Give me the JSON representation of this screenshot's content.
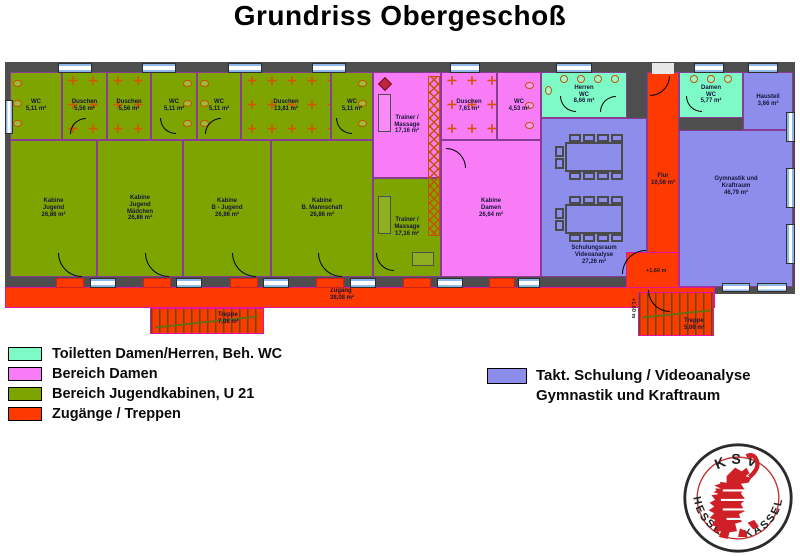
{
  "title": "Grundriss Obergeschoß",
  "rooms": {
    "wc1": {
      "label": "WC\n5,11 m²"
    },
    "du1": {
      "label": "Duschen\n5,56 m²"
    },
    "du2": {
      "label": "Duschen\n5,56 m²"
    },
    "wc2": {
      "label": "WC\n5,11 m²"
    },
    "wc3": {
      "label": "WC\n5,11 m²"
    },
    "duw": {
      "label": "Duschen\n13,81 m²"
    },
    "wc4": {
      "label": "WC\n5,11 m²"
    },
    "kab1": {
      "label": "Kabine\nJugend\n26,86 m²"
    },
    "kab2": {
      "label": "Kabine\nJugend\nMädchen\n26,86 m²"
    },
    "kab3": {
      "label": "Kabine\nB - Jugend\n26,86 m²"
    },
    "kab4": {
      "label": "Kabine\nB. Mannschaft\n26,86 m²"
    },
    "tm_pink": {
      "label": "Trainer /\nMassage\n17,16 m²"
    },
    "tm_green": {
      "label": "Trainer /\nMassage\n17,16 m²"
    },
    "du_damen": {
      "label": "Duschen\n7,61 m²"
    },
    "wc_damen": {
      "label": "WC\n4,53 m²"
    },
    "kab_damen": {
      "label": "Kabine\nDamen\n26,64 m²"
    },
    "herren_wc": {
      "label": "Herren\nWC\n8,66 m²"
    },
    "damen_wc": {
      "label": "Damen\nWC\n5,77 m²"
    },
    "hausteil": {
      "label": "Hausteil\n3,66 m²"
    },
    "flur": {
      "label": "Flur\n10,56 m²"
    },
    "schulung": {
      "label": "Schulungsraum\nVideoanalyse\n27,26 m²"
    },
    "gym": {
      "label": "Gymnastik und\nKraftraum\n46,79 m²"
    },
    "zugang": {
      "label": "Zugang\n38,08 m²"
    },
    "treppe1": {
      "label": "Treppe\n7,08 m²"
    },
    "treppe2": {
      "label": "Treppe\n5,06 m²"
    }
  },
  "annotations": {
    "level_a": "+1,60 m",
    "level_b": "+1,60 m"
  },
  "legend_left": [
    {
      "label": "Toiletten Damen/Herren, Beh. WC",
      "color": "#7efac6"
    },
    {
      "label": "Bereich Damen",
      "color": "#f87cf6"
    },
    {
      "label": "Bereich Jugendkabinen, U 21",
      "color": "#7ea402"
    },
    {
      "label": "Zugänge / Treppen",
      "color": "#ff3a00"
    }
  ],
  "legend_right": {
    "color": "#8d8dec",
    "line1": "Takt. Schulung / Videoanalyse",
    "line2": "Gymnastik und Kraftraum"
  },
  "logo": {
    "top": "KSV",
    "bottom_left": "HESSEN",
    "bottom_right": "KASSEL"
  }
}
